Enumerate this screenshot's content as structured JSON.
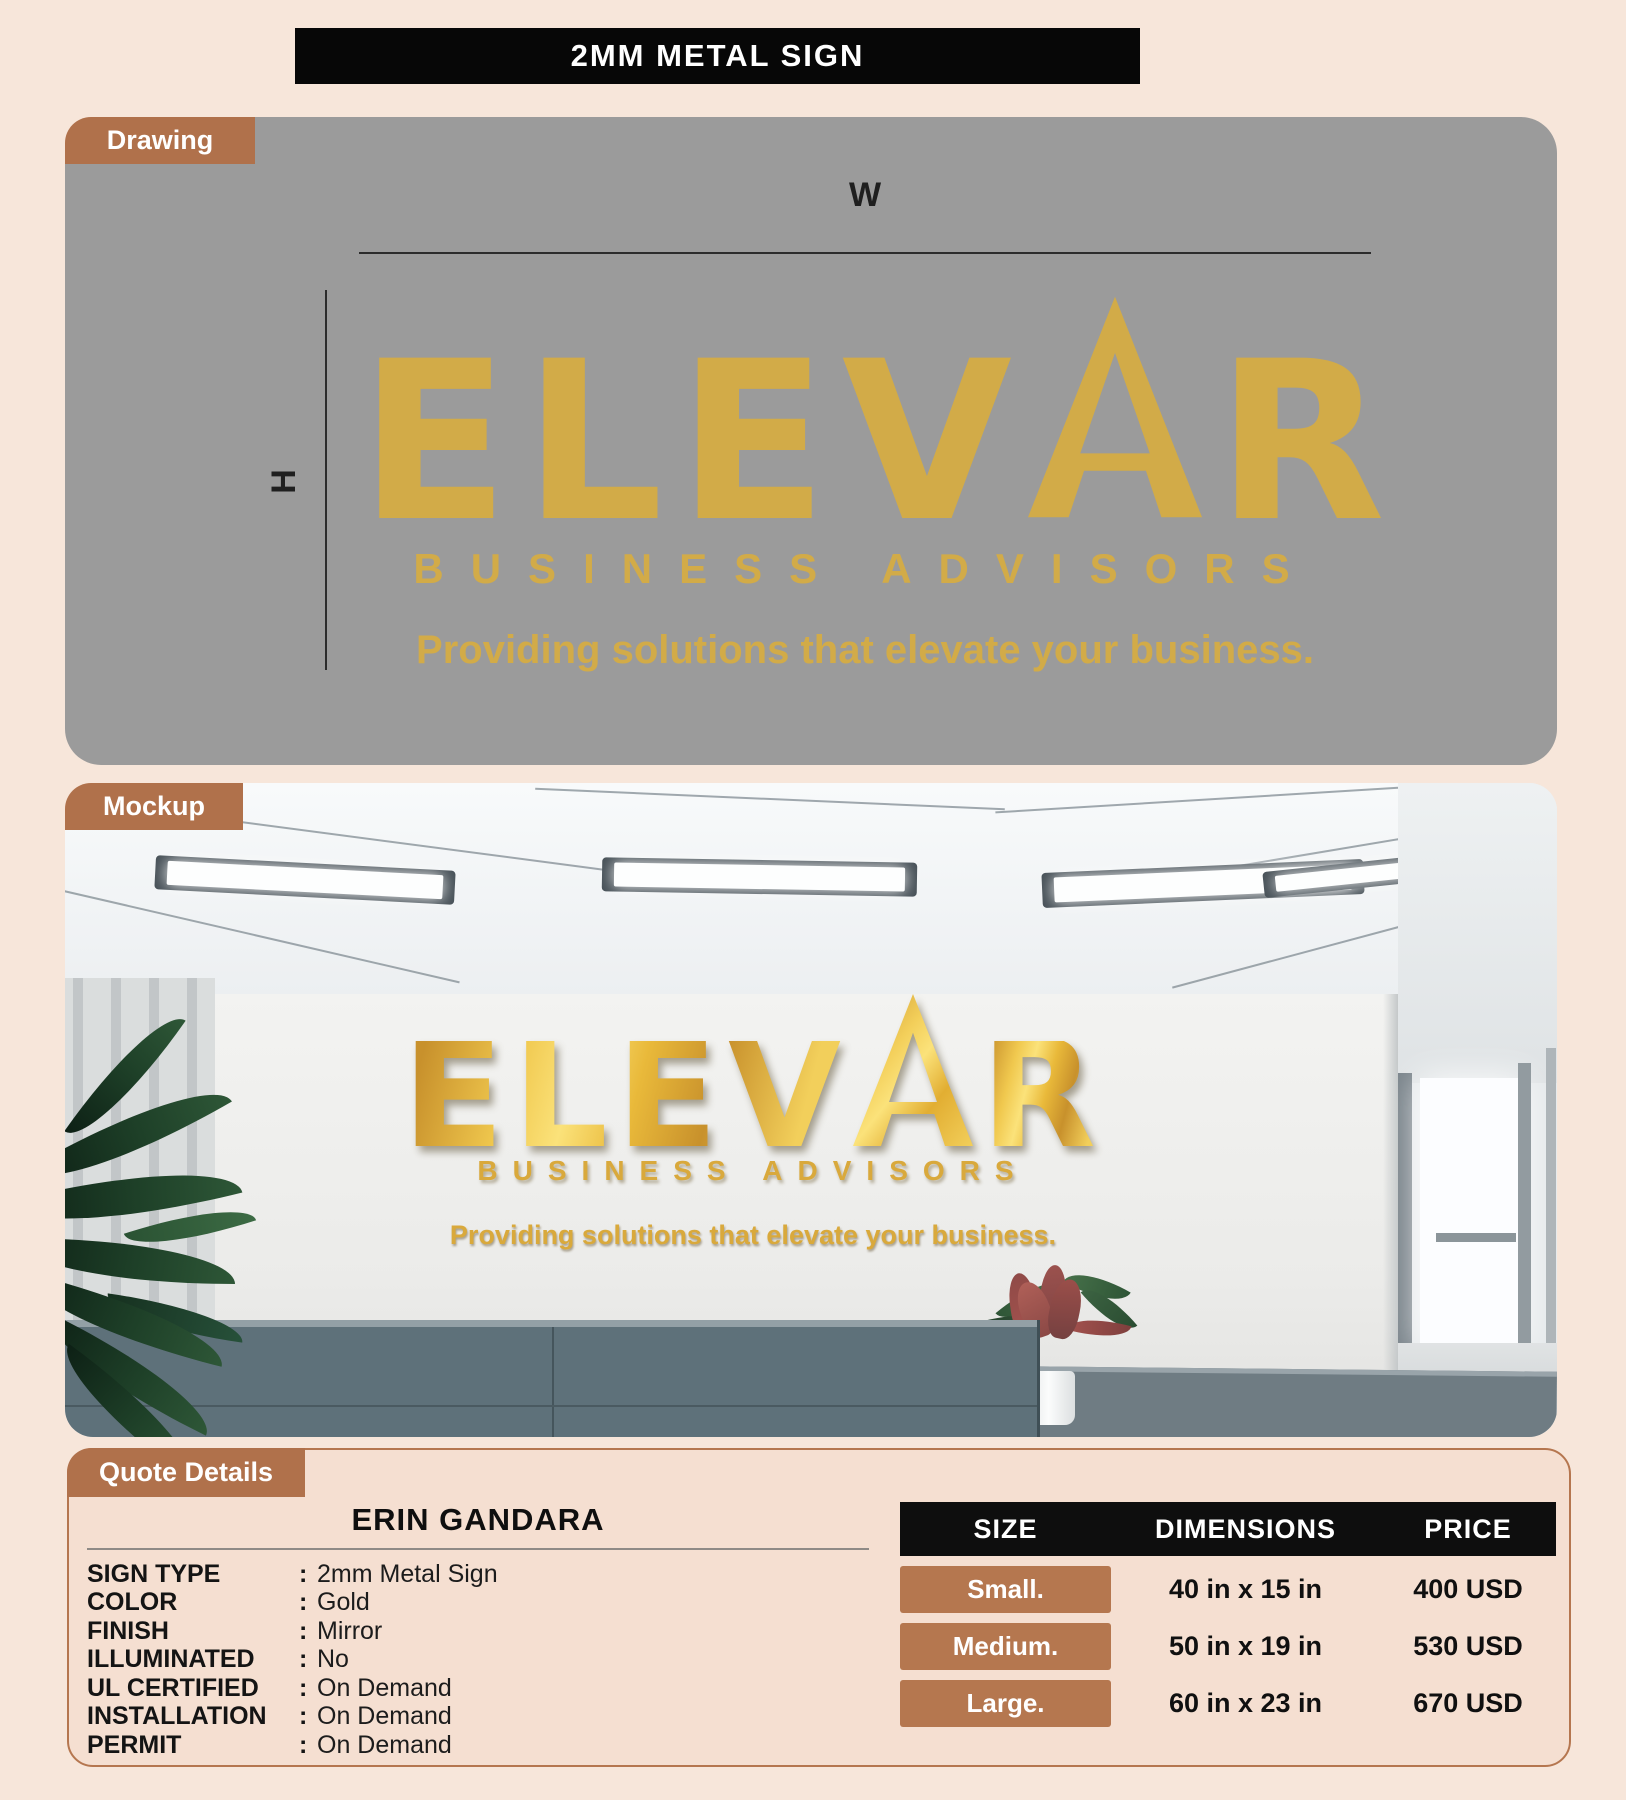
{
  "title": "2MM METAL SIGN",
  "tabs": {
    "drawing": "Drawing",
    "mockup": "Mockup",
    "quote": "Quote Details"
  },
  "dimension_labels": {
    "width": "W",
    "height": "H"
  },
  "logo": {
    "name_left": "ELEV",
    "name_right": "R",
    "subtitle": "BUSINESS ADVISORS",
    "tagline": "Providing solutions that elevate your business."
  },
  "quote": {
    "customer": "ERIN GANDARA",
    "colon": ":",
    "fields": [
      {
        "label": "SIGN TYPE",
        "value": "2mm Metal Sign"
      },
      {
        "label": "COLOR",
        "value": "Gold"
      },
      {
        "label": "FINISH",
        "value": "Mirror"
      },
      {
        "label": "ILLUMINATED",
        "value": "No"
      },
      {
        "label": "UL CERTIFIED",
        "value": "On Demand"
      },
      {
        "label": "INSTALLATION",
        "value": "On Demand"
      },
      {
        "label": "PERMIT",
        "value": "On Demand"
      }
    ]
  },
  "pricing": {
    "headers": [
      "SIZE",
      "DIMENSIONS",
      "PRICE"
    ],
    "rows": [
      {
        "size": "Small.",
        "dimensions": "40 in x 15 in",
        "price": "400 USD"
      },
      {
        "size": "Medium.",
        "dimensions": "50 in x 19 in",
        "price": "530 USD"
      },
      {
        "size": "Large.",
        "dimensions": "60 in x 23 in",
        "price": "670 USD"
      }
    ]
  },
  "colors": {
    "page_bg": "#f7e6da",
    "accent_brown": "#b0714b",
    "gold_flat": "#d2ab48",
    "gold_metallic": "#e9b93a",
    "drawing_bg": "#9b9b9b",
    "table_header_bg": "#0e0e0e"
  }
}
